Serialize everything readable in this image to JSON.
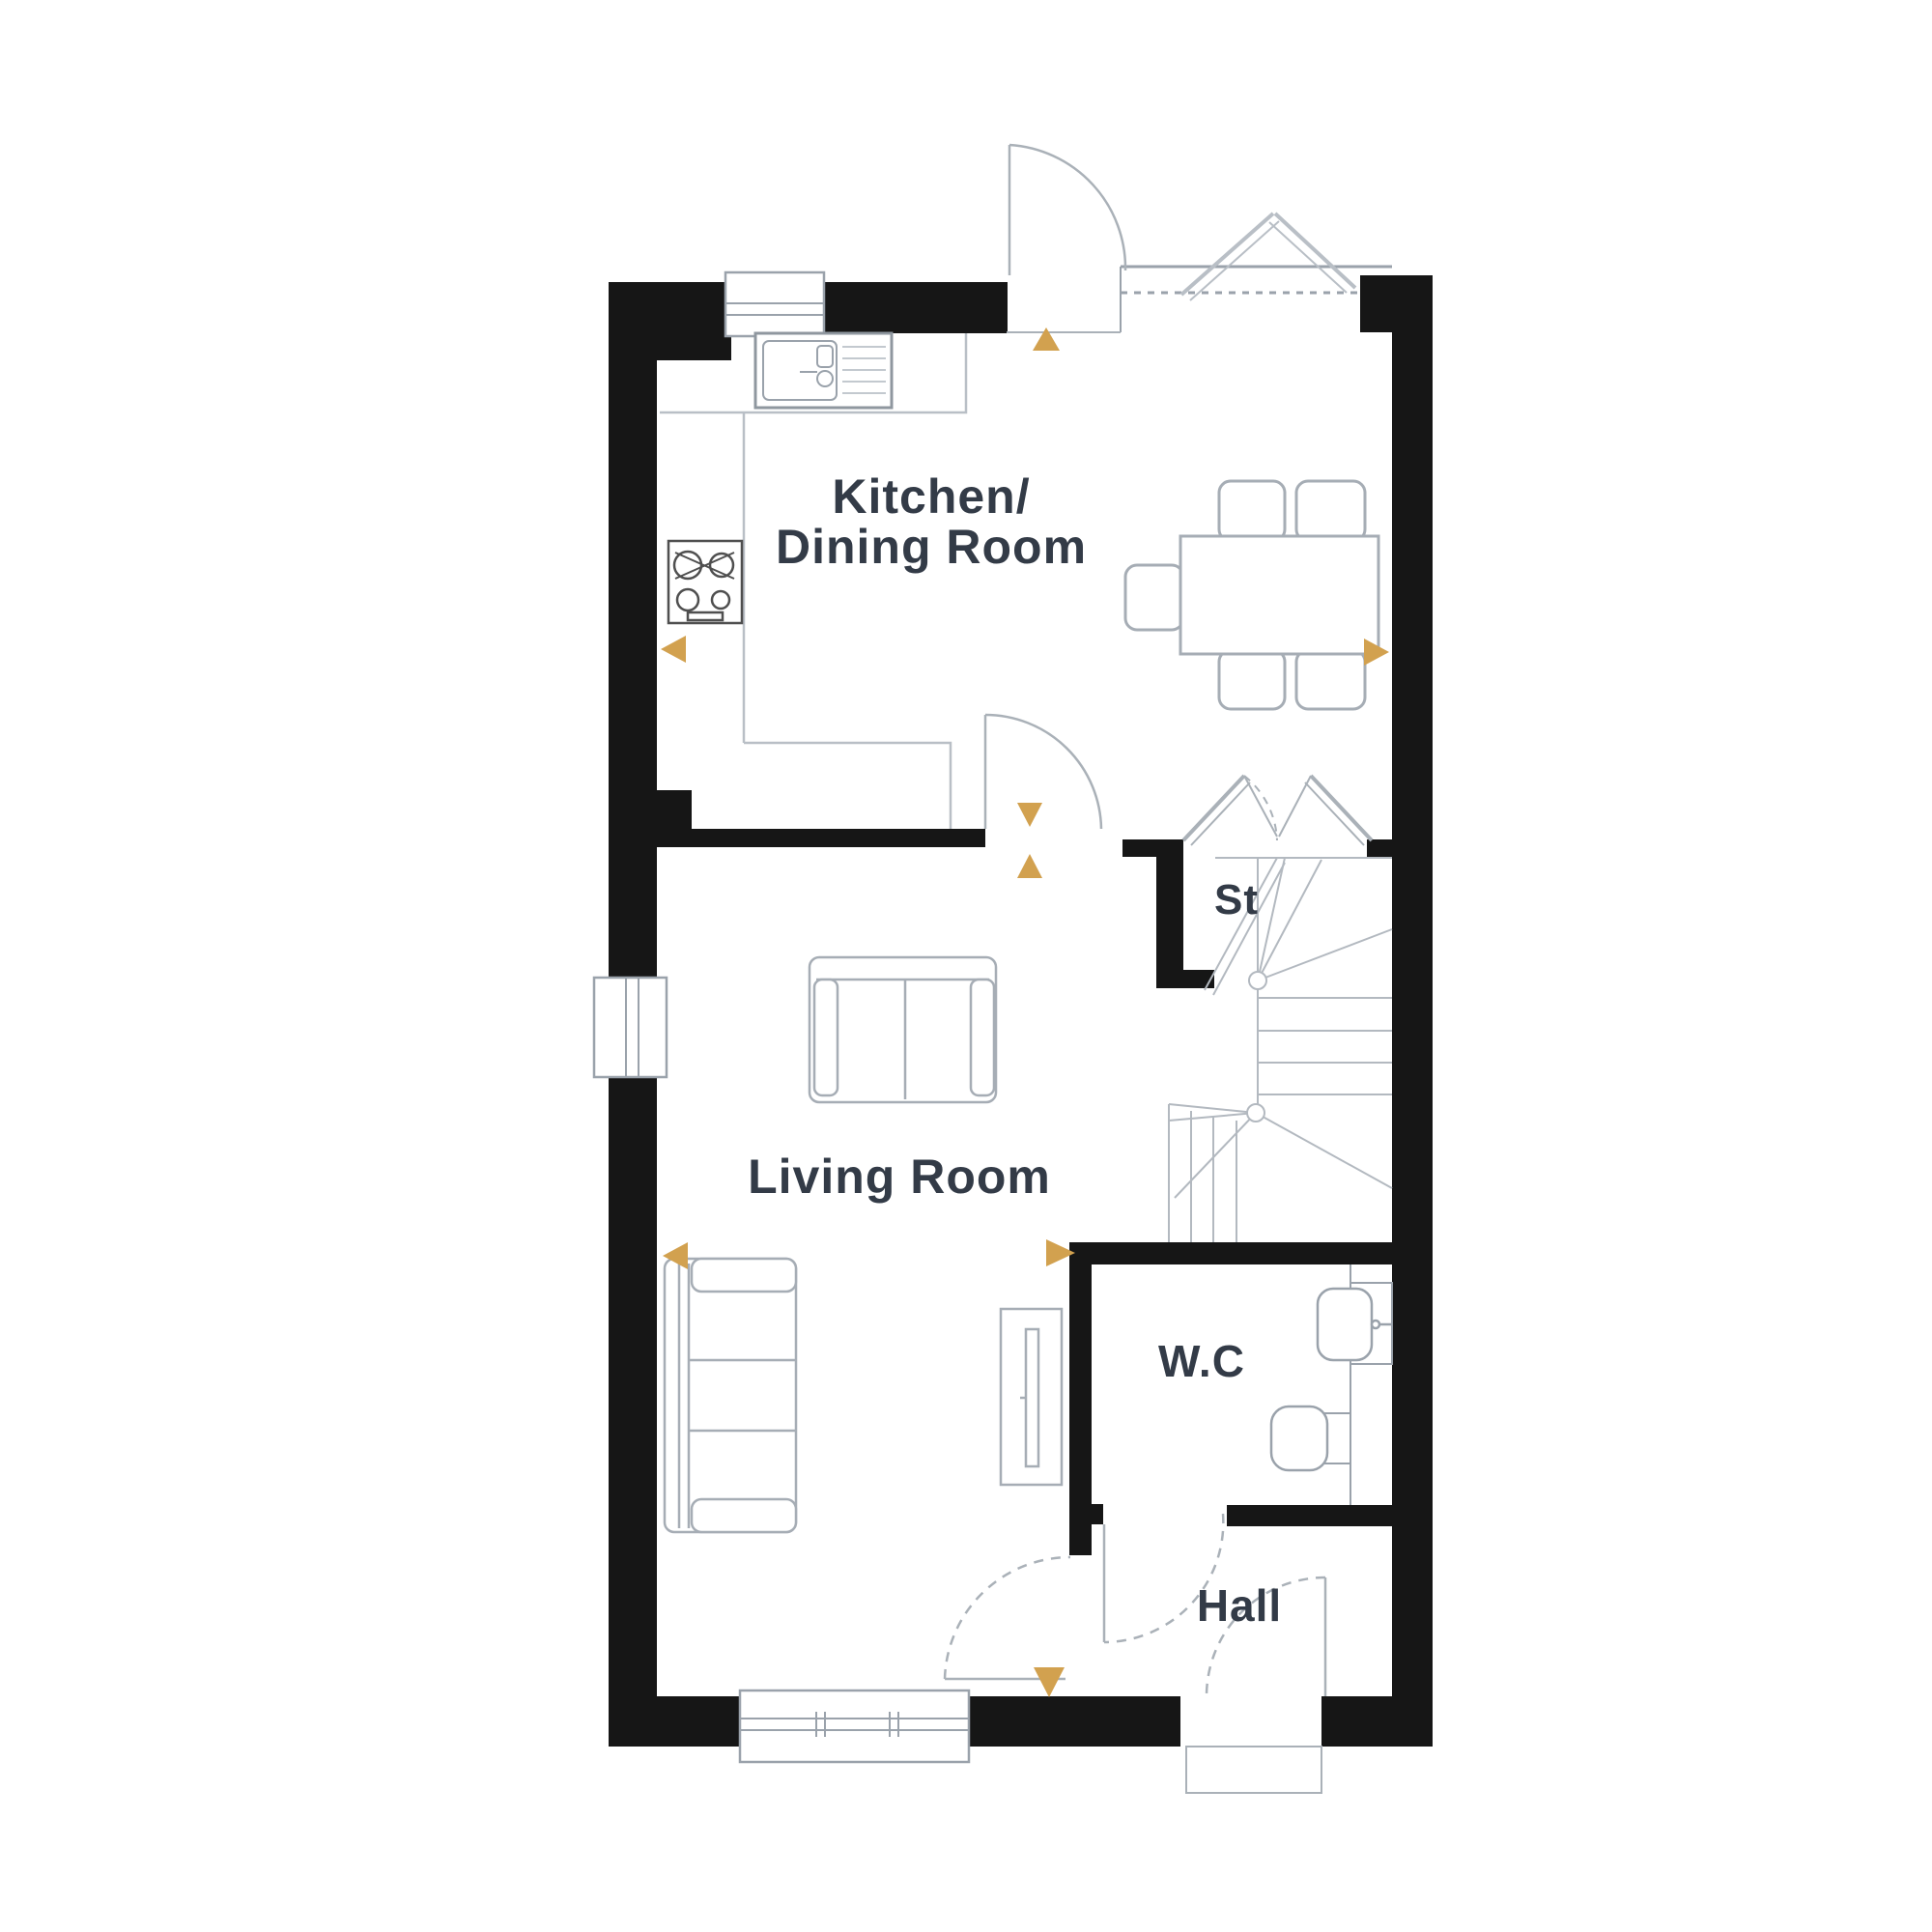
{
  "meta": {
    "type": "floor-plan",
    "view": "ground-floor-plan"
  },
  "palette": {
    "wall": "#161616",
    "furniture_stroke": "#a6adb5",
    "counter_stroke": "#b9bfc6",
    "door_stroke": "#aab1b8",
    "stair_stroke": "#b3b9c0",
    "fixture_stroke": "#9aa2ab",
    "hob_stroke": "#4f4f4f",
    "accent_arrow": "#d2a14f",
    "label_color": "#333b47"
  },
  "rooms": {
    "kitchen_dining": {
      "label_line1": "Kitchen/",
      "label_line2": "Dining Room"
    },
    "living": {
      "label": "Living Room"
    },
    "store": {
      "label": "St"
    },
    "wc": {
      "label": "W.C"
    },
    "hall": {
      "label": "Hall"
    }
  }
}
